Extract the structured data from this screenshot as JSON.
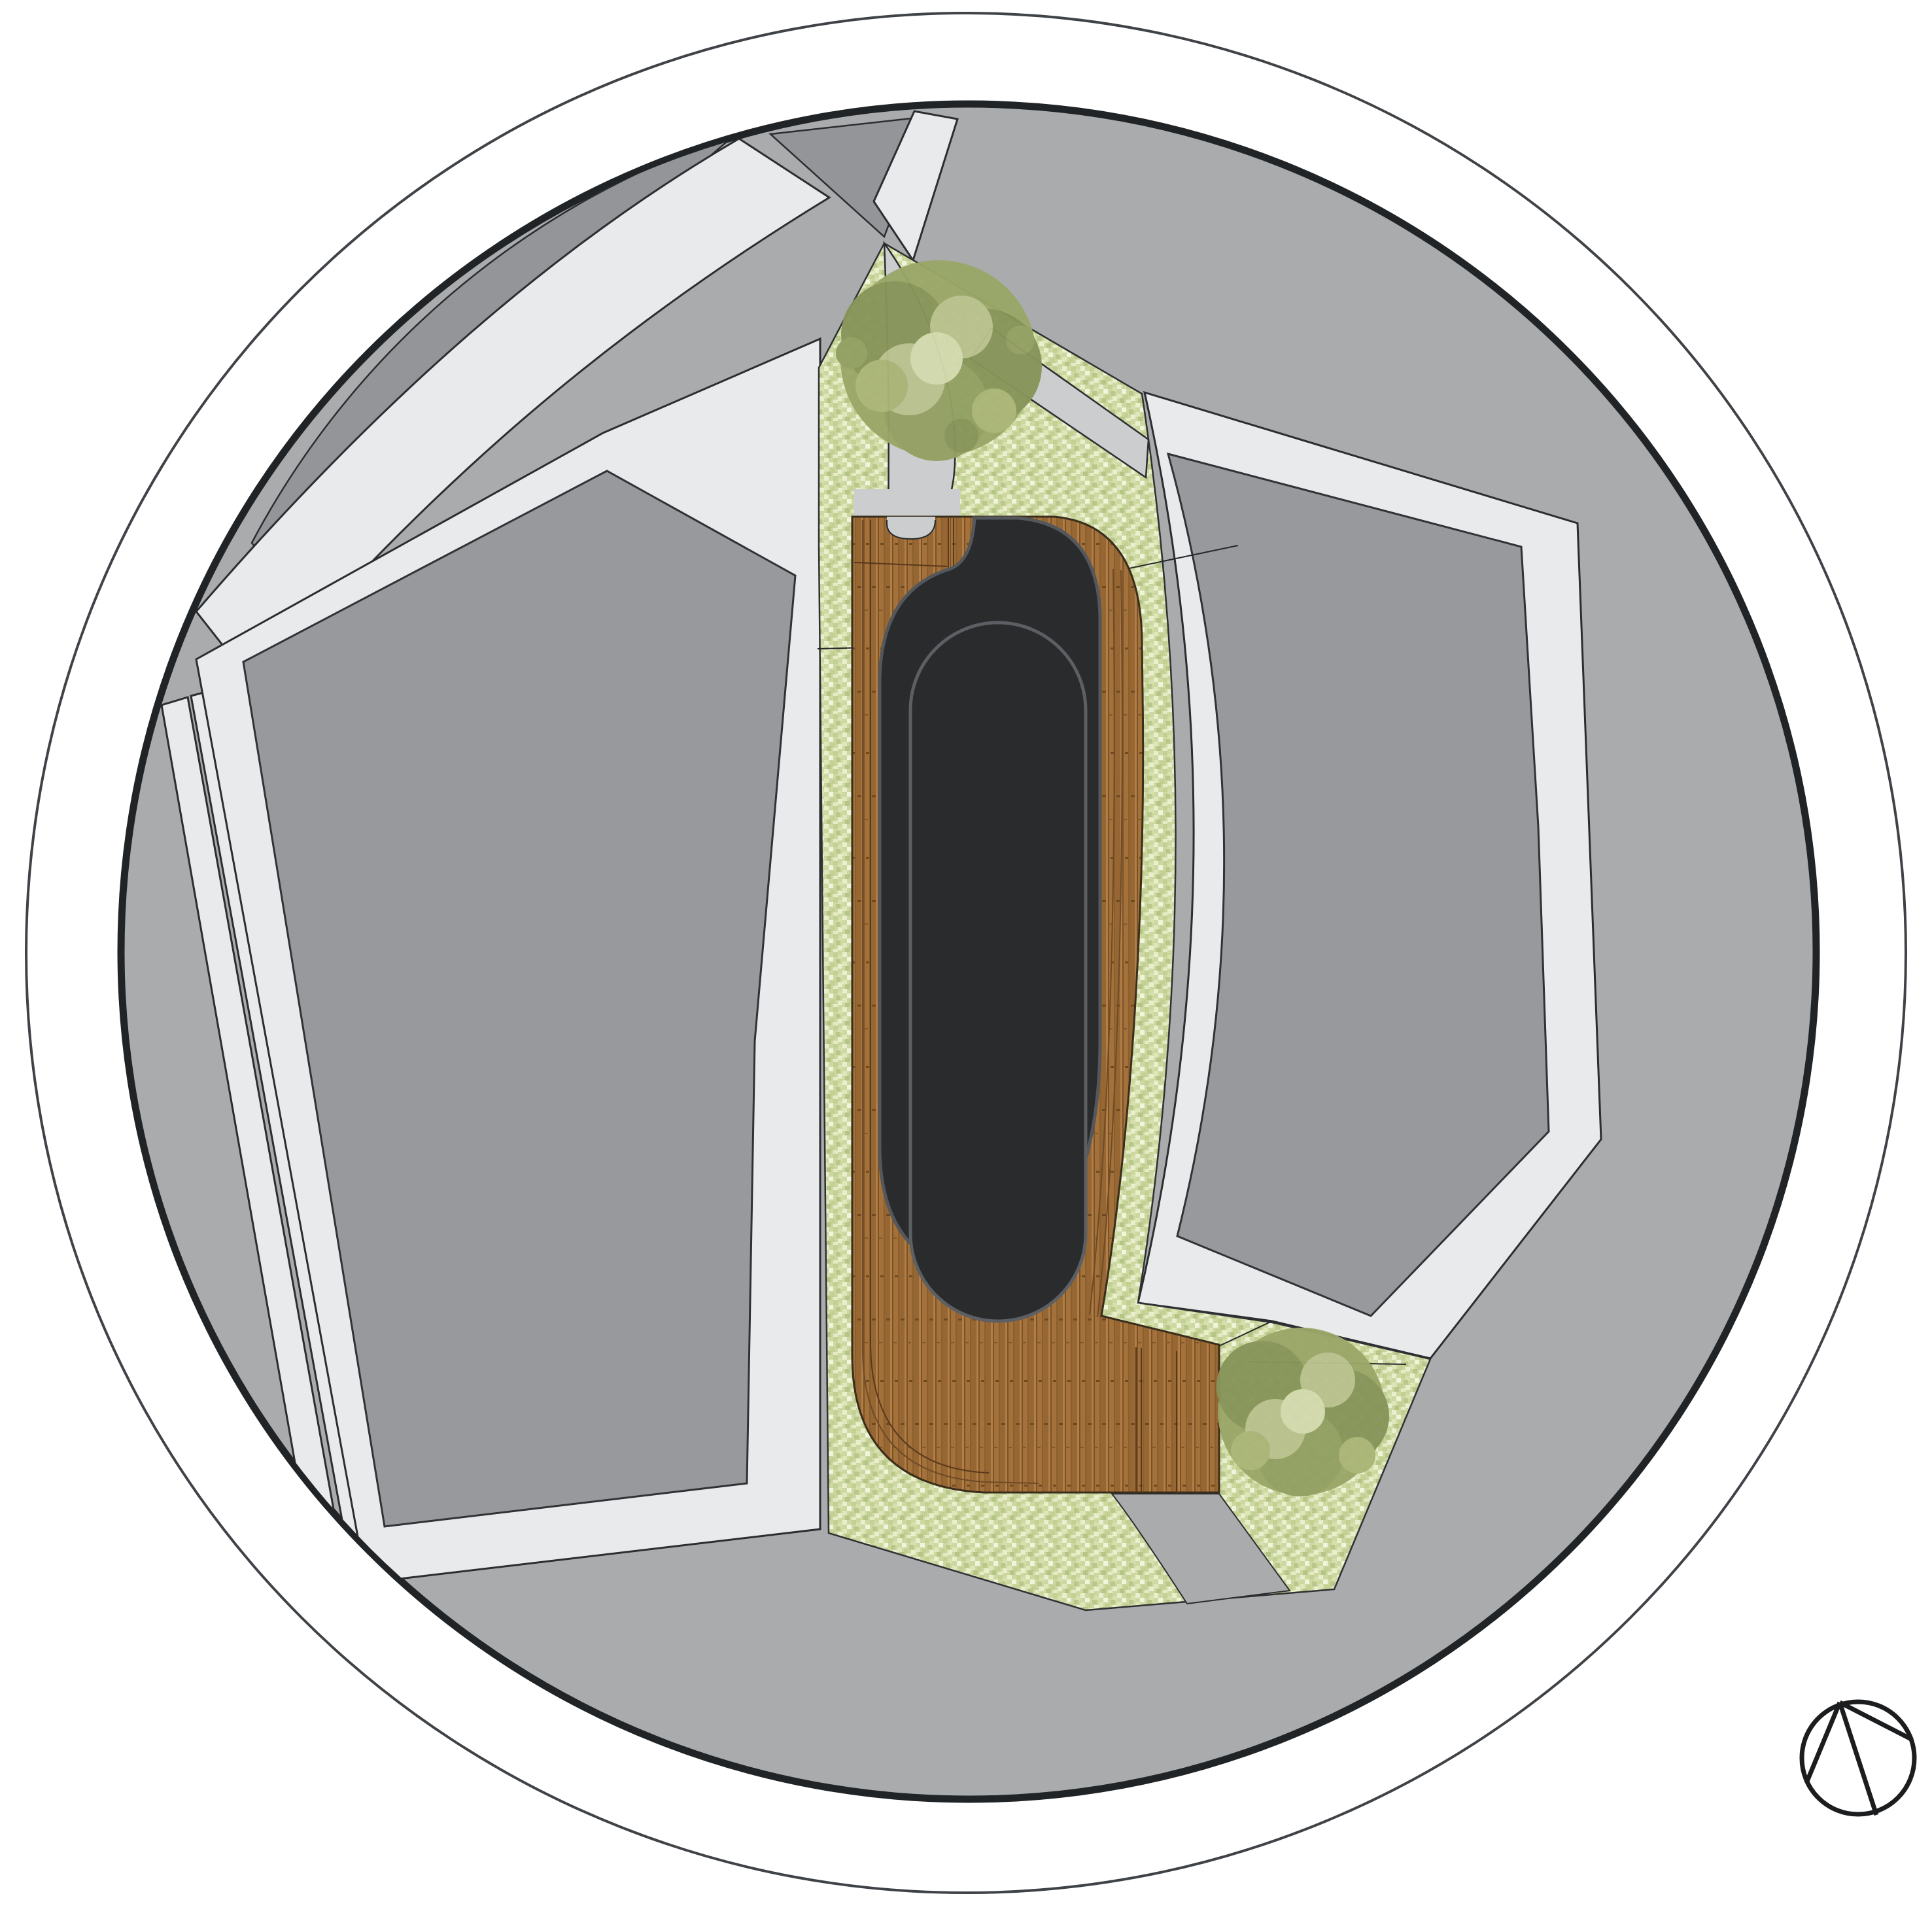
{
  "document": {
    "type": "architectural site plan",
    "projection": "top-down roof plan",
    "crop": "circular vignette on white page",
    "text_content": "none (drawing only)"
  },
  "colors": {
    "page_bg": "#ffffff",
    "outer_ring_stroke": "#3f4347",
    "inner_rim_stroke": "#212426",
    "ground": "#a9abad",
    "parcel_dark": "#939598",
    "block_gray": "#97999c",
    "road_light": "#e9eaec",
    "path_gray": "#cbcdcf",
    "lawn_base": "#ccd8a0",
    "wood_mid": "#9c6b38",
    "wood_dark": "#7b5226",
    "wood_light": "#b07e46",
    "roof_dark": "#2a2b2d",
    "canopy_base": "#9aa768",
    "canopy_dark": "#87955a",
    "canopy_light": "#b9c28e",
    "canopy_pale": "#d3daae",
    "north_arrow_stroke": "#1b1d1f"
  },
  "elements": {
    "outer_boundary": "circular drawing boundary ring",
    "inner_site": "circular site extent filled with plaza ground",
    "top_left_parcel": "neighboring parcel north-west (dark gray)",
    "top_triangle_parcel": "small triangular island at north",
    "top_road": "curved pedestrian road sweeping from north to west",
    "v_road_arm": "short road arm reaching north rim",
    "left_roads": "two parallel diagonal walks on west side",
    "left_block": "west building block with light sidewalk margin",
    "right_block": "east building block with light sidewalk margin",
    "lawn": "stippled lawn / planting strip through center",
    "central_path": "entry footpath from north into deck",
    "branch_path": "footpath linking lawn to east sidewalk",
    "south_path": "footpath through south lawn",
    "deck": "timber deck wrapping building and south terrace",
    "roof": "dark rounded building roof",
    "inner_roof": "upper roof volume outline (stadium shape)",
    "tree_north": "tree canopy on north lawn",
    "tree_south": "tree canopy on south lawn",
    "north_arrow": "north arrow circle symbol bottom-right"
  }
}
